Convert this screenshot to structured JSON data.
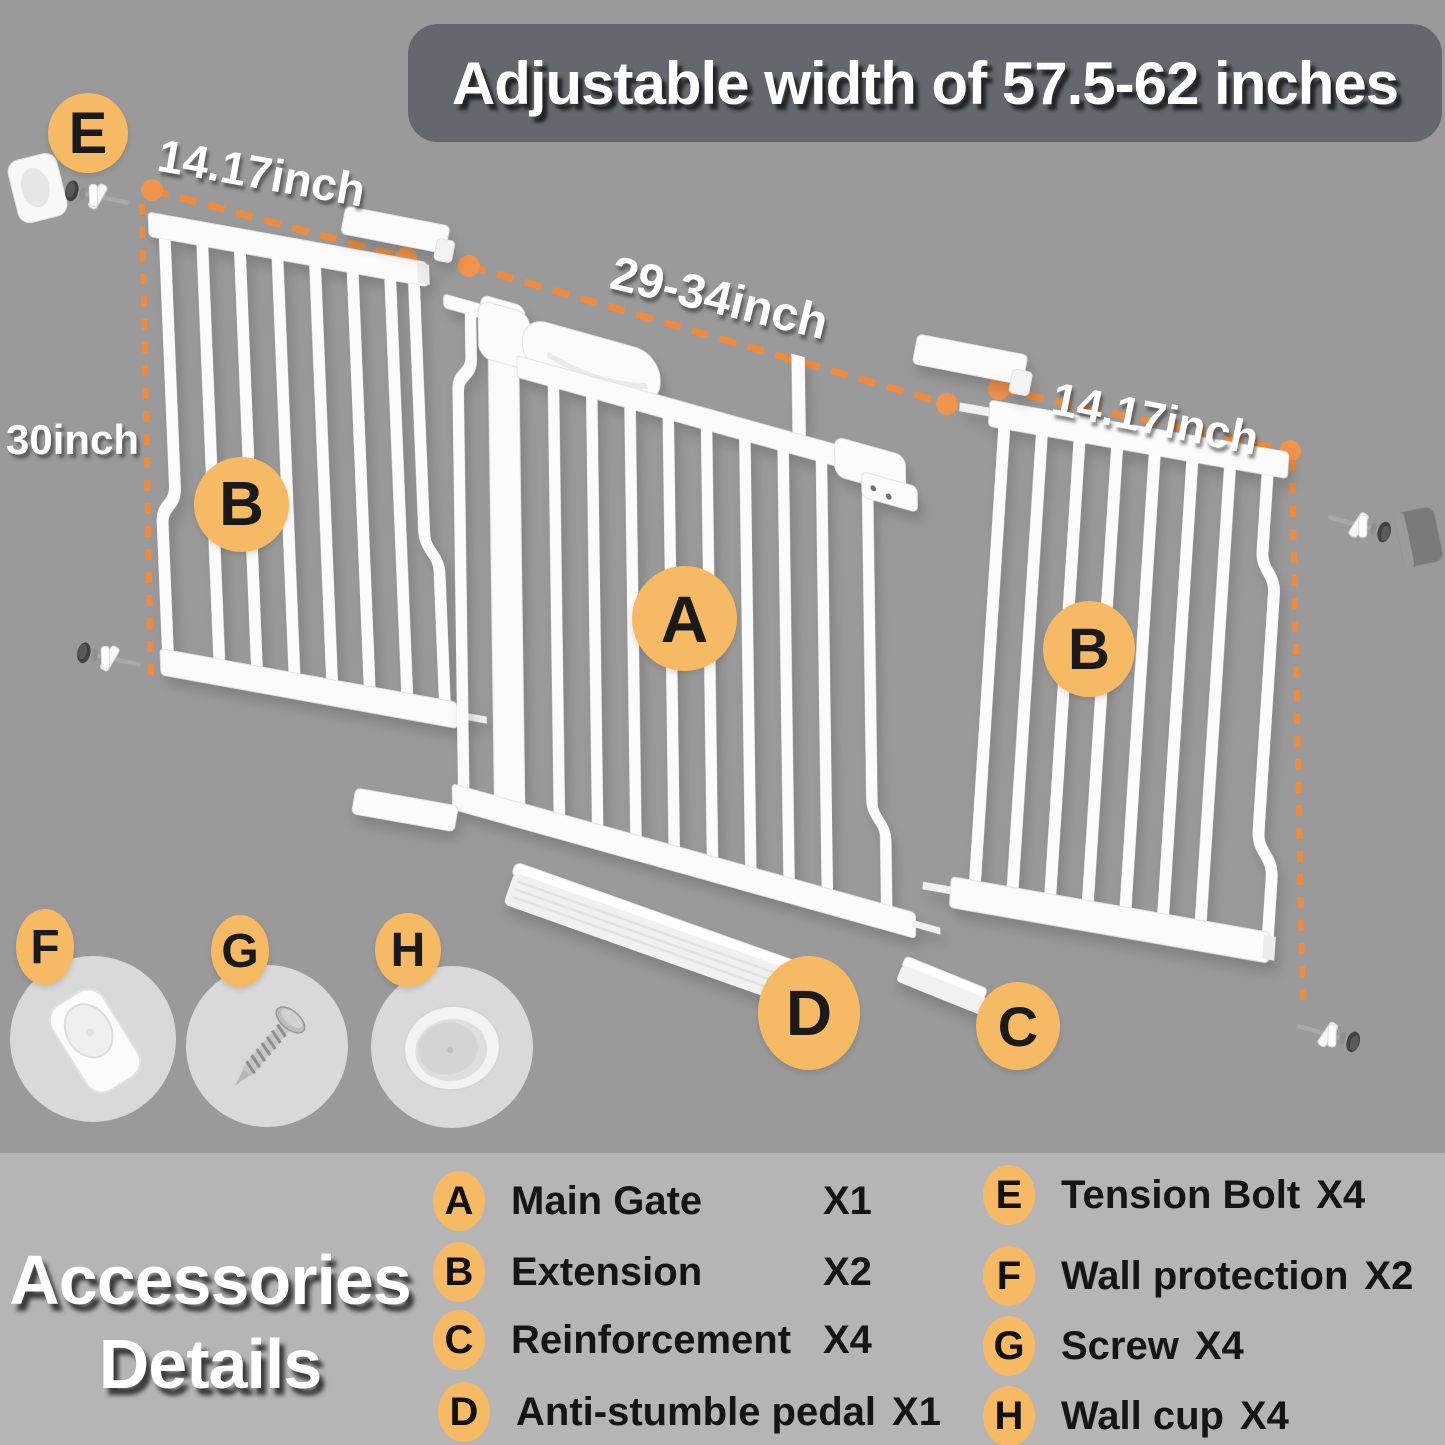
{
  "banner": {
    "text": "Adjustable width of 57.5-62 inches"
  },
  "diagram": {
    "labels": {
      "height": "30inch",
      "left_extension": "14.17inch",
      "main_gate": "29-34inch",
      "right_extension": "14.17inch"
    },
    "badges": {
      "main_gate": "A",
      "extension_left": "B",
      "extension_right": "B",
      "reinforcement": "C",
      "pedal": "D",
      "tension_bolt": "E",
      "wall_protection": "F",
      "screw": "G",
      "wall_cup": "H"
    }
  },
  "legend": {
    "title_line1": "Accessories",
    "title_line2": "Details",
    "left": [
      {
        "letter": "A",
        "label": "Main Gate",
        "qty": "X1"
      },
      {
        "letter": "B",
        "label": "Extension",
        "qty": "X2"
      },
      {
        "letter": "C",
        "label": "Reinforcement",
        "qty": "X4"
      },
      {
        "letter": "D",
        "label": "Anti-stumble pedal",
        "qty": "X1"
      }
    ],
    "right": [
      {
        "letter": "E",
        "label": "Tension Bolt",
        "qty": "X4"
      },
      {
        "letter": "F",
        "label": "Wall protection",
        "qty": "X2"
      },
      {
        "letter": "G",
        "label": "Screw",
        "qty": "X4"
      },
      {
        "letter": "H",
        "label": "Wall cup",
        "qty": "X4"
      }
    ]
  },
  "colors": {
    "badge_orange": "#F6BA64",
    "dash_orange": "#EE8B3E",
    "banner_bg": "#64686E",
    "bg_top": "#9A9A9A",
    "bg_bottom": "#B5B5B5",
    "item_circle": "#D9D9D9"
  }
}
